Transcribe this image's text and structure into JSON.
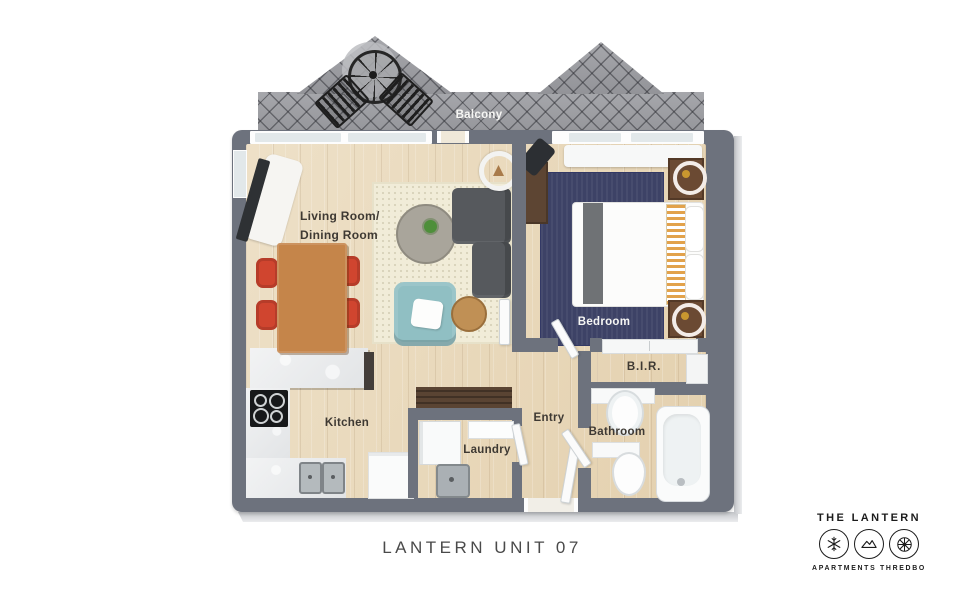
{
  "colors": {
    "wall": "#6d727d",
    "floor": "#e9d8b8",
    "tile": "#9c9da2",
    "glass": "#e2e8ea",
    "rug-cream": "#f1ecd8",
    "rug-cream-dot": "#d9d3ba",
    "rug-navy": "#3d4266",
    "sofa": "#56595d",
    "armchair": "#90bfc3",
    "wood-table": "#c5854a",
    "chair-red": "#d0452f",
    "coffee-table": "#a9a59b",
    "side-table": "#c09055",
    "bench-wood": "#5a4433",
    "dark-wood": "#5d4533",
    "nightstand": "#6b4a33",
    "bed-runner": "#6f7275",
    "stripe-orange": "#e2a24b",
    "cooktop": "#17181a",
    "lamp-gold": "#c9972f",
    "plant-green": "#4e8f3a",
    "label-dark": "#3e3933",
    "label-light": "#f6f6f4",
    "title-color": "#4a4a4a",
    "logo-color": "#1c1c1c"
  },
  "plan": {
    "labels": {
      "balcony": "Balcony",
      "living1": "Living Room/",
      "living2": "Dining Room",
      "bedroom": "Bedroom",
      "kitchen": "Kitchen",
      "laundry": "Laundry",
      "entry": "Entry",
      "bathroom": "Bathroom",
      "bir": "B.I.R."
    }
  },
  "caption": {
    "title": "LANTERN UNIT 07"
  },
  "logo": {
    "name": "THE LANTERN",
    "subtitle": "APARTMENTS THREDBO",
    "icons": [
      "snowflake-icon",
      "mountain-icon",
      "wheel-icon"
    ]
  }
}
